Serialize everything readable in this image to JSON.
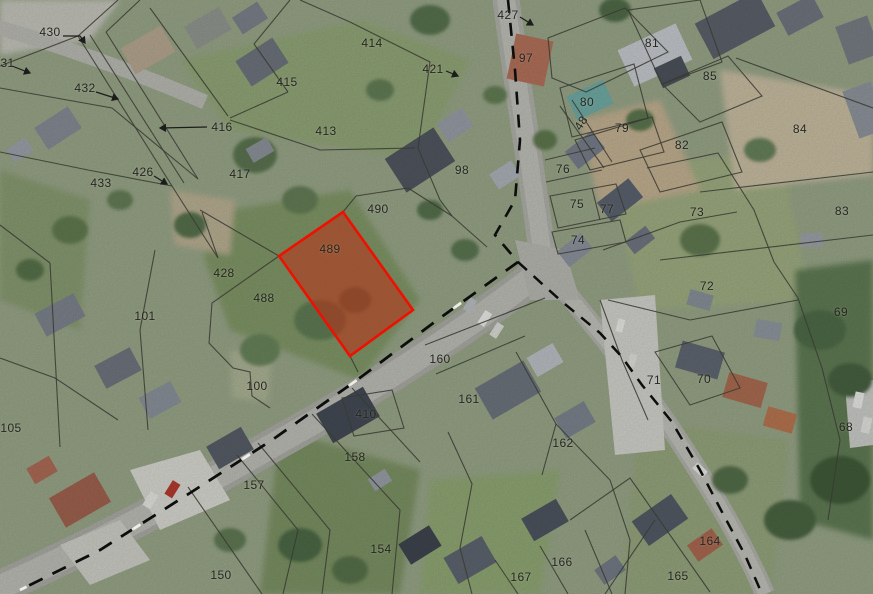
{
  "map": {
    "type": "cadastral-aerial-view",
    "selected_parcel_id": "489",
    "colors": {
      "selection_fill": "#c42a12",
      "selection_stroke": "#ee1000",
      "boundary_line": "#3a3a33",
      "road_dash": "#0d0d0d",
      "label_text": "#26261f"
    },
    "parcels": [
      {
        "label": "430",
        "x": 50,
        "y": 32
      },
      {
        "label": "431",
        "x": 4,
        "y": 63
      },
      {
        "label": "432",
        "x": 85,
        "y": 88
      },
      {
        "label": "433",
        "x": 101,
        "y": 183
      },
      {
        "label": "426",
        "x": 143,
        "y": 172
      },
      {
        "label": "416",
        "x": 222,
        "y": 127
      },
      {
        "label": "417",
        "x": 240,
        "y": 174
      },
      {
        "label": "415",
        "x": 287,
        "y": 82
      },
      {
        "label": "413",
        "x": 326,
        "y": 131
      },
      {
        "label": "414",
        "x": 372,
        "y": 43
      },
      {
        "label": "421",
        "x": 433,
        "y": 69
      },
      {
        "label": "427",
        "x": 508,
        "y": 15
      },
      {
        "label": "97",
        "x": 526,
        "y": 58
      },
      {
        "label": "98",
        "x": 462,
        "y": 170
      },
      {
        "label": "80",
        "x": 587,
        "y": 102
      },
      {
        "label": "79",
        "x": 622,
        "y": 128
      },
      {
        "label": "81",
        "x": 652,
        "y": 43
      },
      {
        "label": "85",
        "x": 710,
        "y": 76
      },
      {
        "label": "82",
        "x": 682,
        "y": 145
      },
      {
        "label": "84",
        "x": 800,
        "y": 129
      },
      {
        "label": "83",
        "x": 842,
        "y": 211
      },
      {
        "label": "48",
        "x": 581,
        "y": 123,
        "rot": -57
      },
      {
        "label": "76",
        "x": 563,
        "y": 169
      },
      {
        "label": "75",
        "x": 577,
        "y": 204
      },
      {
        "label": "77",
        "x": 607,
        "y": 209
      },
      {
        "label": "74",
        "x": 578,
        "y": 240
      },
      {
        "label": "73",
        "x": 697,
        "y": 212
      },
      {
        "label": "72",
        "x": 707,
        "y": 286
      },
      {
        "label": "69",
        "x": 841,
        "y": 312
      },
      {
        "label": "68",
        "x": 846,
        "y": 427
      },
      {
        "label": "71",
        "x": 654,
        "y": 380
      },
      {
        "label": "70",
        "x": 704,
        "y": 379
      },
      {
        "label": "490",
        "x": 378,
        "y": 209
      },
      {
        "label": "489",
        "x": 330,
        "y": 249
      },
      {
        "label": "428",
        "x": 224,
        "y": 273
      },
      {
        "label": "488",
        "x": 264,
        "y": 298
      },
      {
        "label": "101",
        "x": 145,
        "y": 316
      },
      {
        "label": "100",
        "x": 257,
        "y": 386
      },
      {
        "label": "105",
        "x": 11,
        "y": 428
      },
      {
        "label": "160",
        "x": 440,
        "y": 359
      },
      {
        "label": "161",
        "x": 469,
        "y": 399
      },
      {
        "label": "410",
        "x": 366,
        "y": 414
      },
      {
        "label": "158",
        "x": 355,
        "y": 457
      },
      {
        "label": "162",
        "x": 563,
        "y": 443
      },
      {
        "label": "157",
        "x": 254,
        "y": 485
      },
      {
        "label": "154",
        "x": 381,
        "y": 549
      },
      {
        "label": "150",
        "x": 221,
        "y": 575
      },
      {
        "label": "167",
        "x": 521,
        "y": 577
      },
      {
        "label": "166",
        "x": 562,
        "y": 562
      },
      {
        "label": "165",
        "x": 678,
        "y": 576
      },
      {
        "label": "164",
        "x": 710,
        "y": 541
      }
    ]
  }
}
